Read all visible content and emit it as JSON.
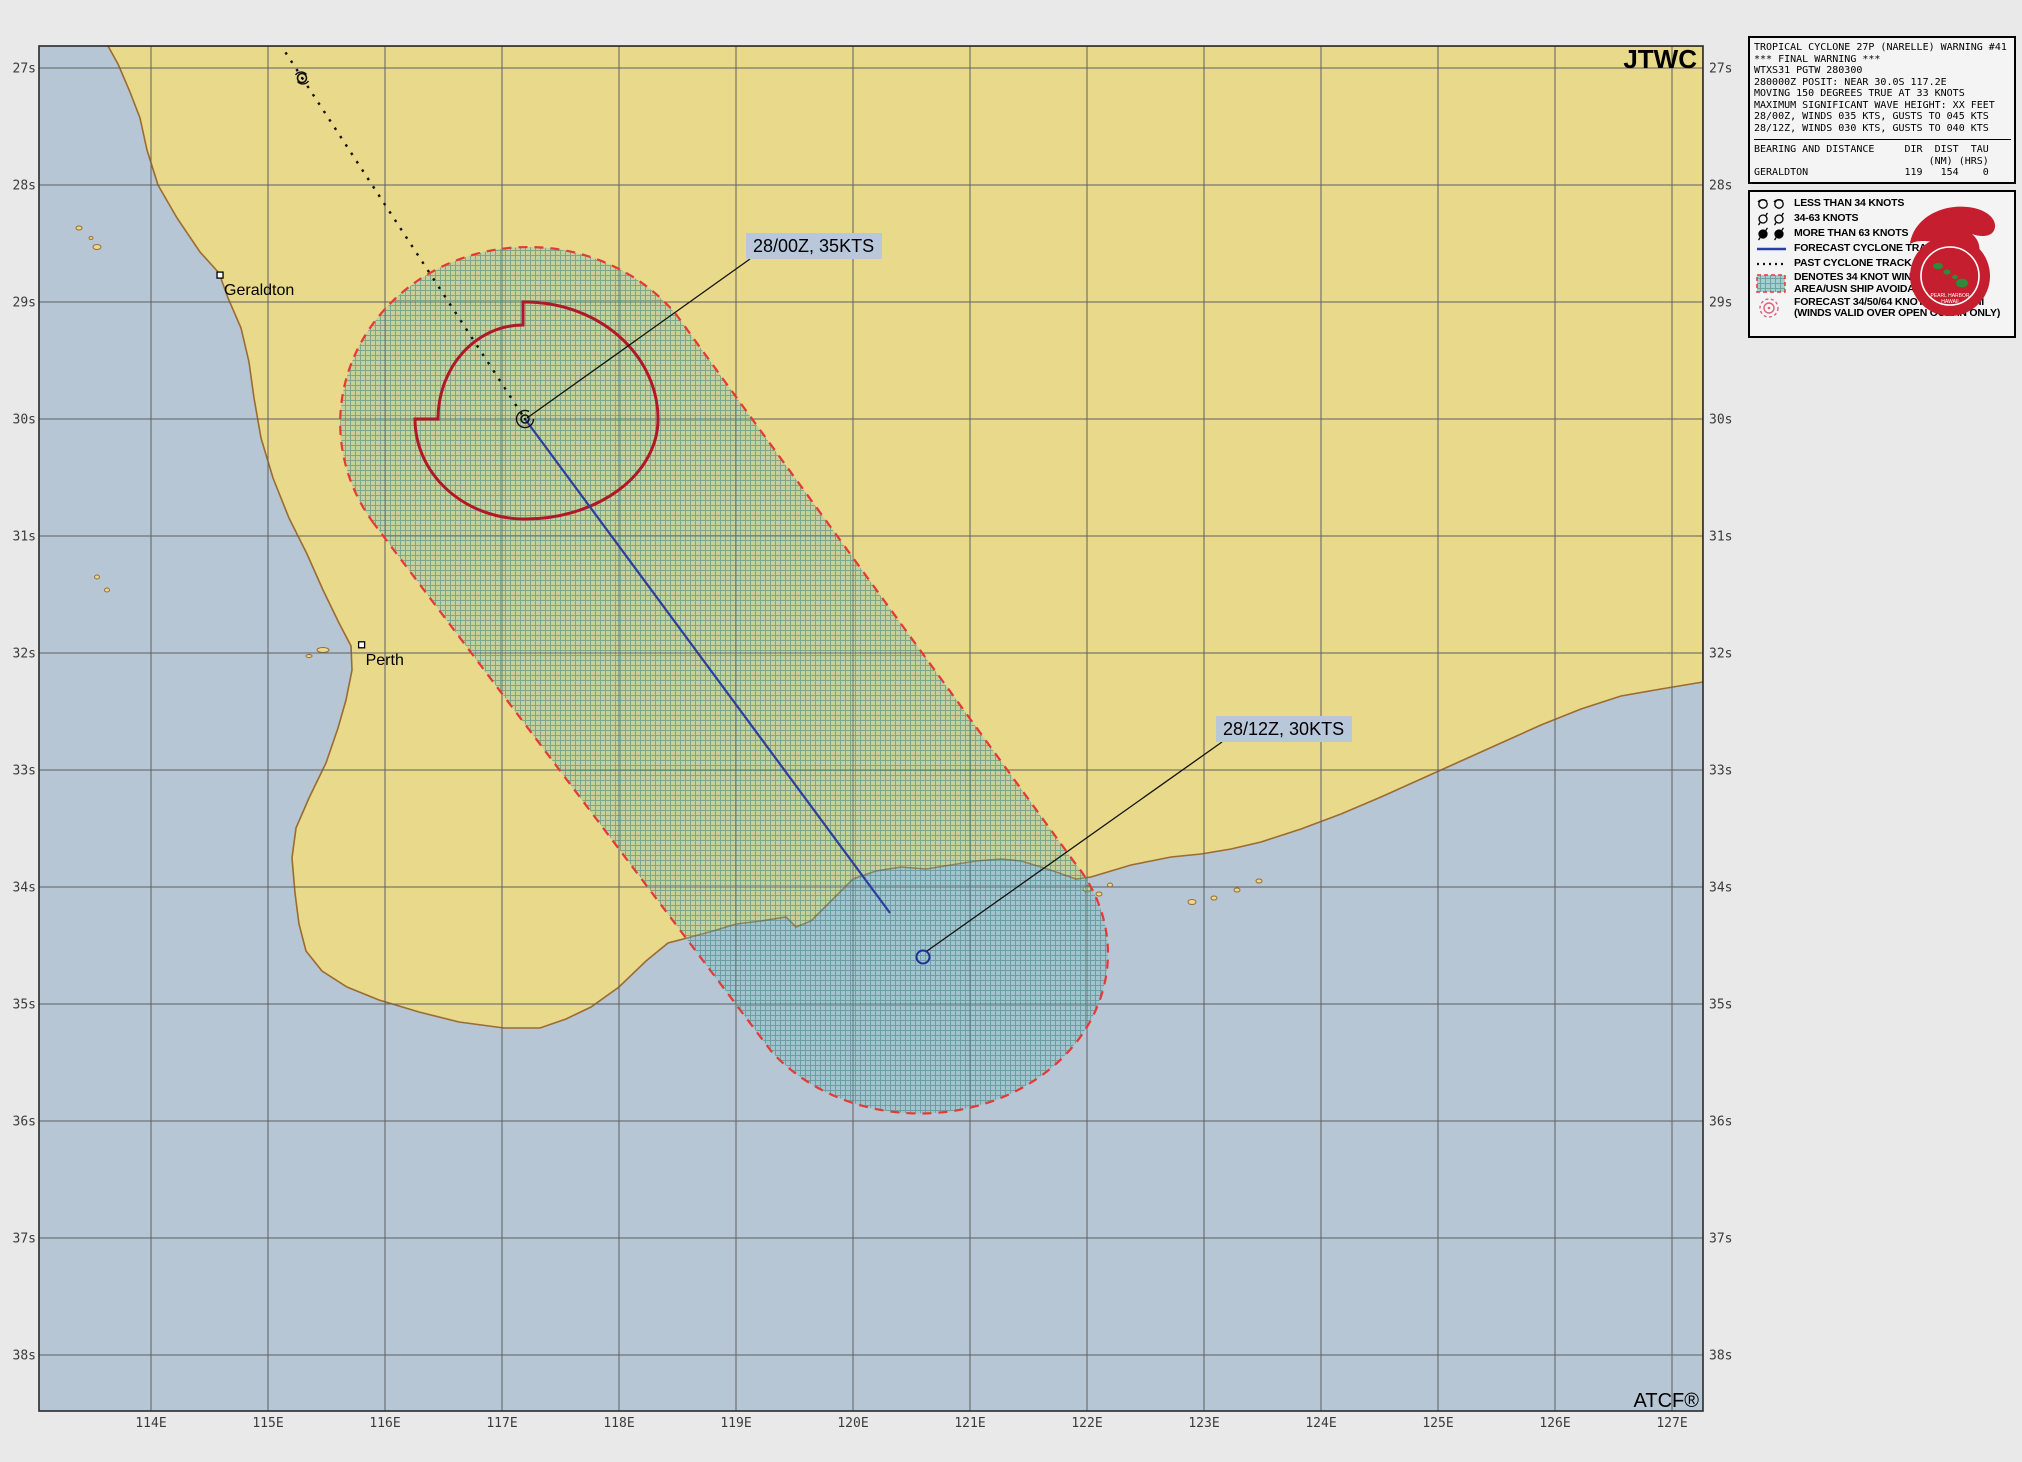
{
  "title": {
    "agency_watermark": "JTWC",
    "software_watermark": "ATCF®"
  },
  "warning_box": {
    "text": "TROPICAL CYCLONE 27P (NARELLE) WARNING #41\n*** FINAL WARNING ***\nWTXS31 PGTW 280300\n280000Z POSIT: NEAR 30.0S 117.2E\nMOVING 150 DEGREES TRUE AT 33 KNOTS\nMAXIMUM SIGNIFICANT WAVE HEIGHT: XX FEET\n28/00Z, WINDS 035 KTS, GUSTS TO 045 KTS\n28/12Z, WINDS 030 KTS, GUSTS TO 040 KTS",
    "bearing_text": "BEARING AND DISTANCE     DIR  DIST  TAU\n                             (NM) (HRS)\nGERALDTON                119   154    0"
  },
  "legend": {
    "items": [
      {
        "id": "lt34",
        "label": "LESS THAN 34 KNOTS"
      },
      {
        "id": "34-63",
        "label": "34-63 KNOTS"
      },
      {
        "id": "gt63",
        "label": "MORE THAN 63 KNOTS"
      },
      {
        "id": "forecast-track",
        "label": "FORECAST CYCLONE TRACK"
      },
      {
        "id": "past-track",
        "label": "PAST CYCLONE TRACK"
      },
      {
        "id": "danger-area",
        "label": "DENOTES 34 KNOT WIND DANGER\nAREA/USN SHIP AVOIDANCE AREA"
      },
      {
        "id": "wind-radii",
        "label": "FORECAST 34/50/64 KNOT WIND RADII\n(WINDS VALID OVER OPEN OCEAN ONLY)"
      }
    ]
  },
  "map": {
    "track_labels": [
      {
        "text": "28/00Z, 35KTS"
      },
      {
        "text": "28/12Z, 30KTS"
      }
    ],
    "cities": [
      {
        "name": "Geraldton",
        "lat_s": 28.77,
        "lon_e": 114.59
      },
      {
        "name": "Perth",
        "lat_s": 31.93,
        "lon_e": 115.8
      }
    ],
    "storm": {
      "id": "27P",
      "name": "NARELLE",
      "current": {
        "time": "28/00Z",
        "lat_s": 30.0,
        "lon_e": 117.2,
        "winds_kts": 35
      },
      "forecast": {
        "time": "28/12Z",
        "lat_s": 34.6,
        "lon_e": 120.6,
        "winds_kts": 30
      }
    },
    "lat_ticks": [
      {
        "label": "27s",
        "value": 27
      },
      {
        "label": "28s",
        "value": 28
      },
      {
        "label": "29s",
        "value": 29
      },
      {
        "label": "30s",
        "value": 30
      },
      {
        "label": "31s",
        "value": 31
      },
      {
        "label": "32s",
        "value": 32
      },
      {
        "label": "33s",
        "value": 33
      },
      {
        "label": "34s",
        "value": 34
      },
      {
        "label": "35s",
        "value": 35
      },
      {
        "label": "36s",
        "value": 36
      },
      {
        "label": "37s",
        "value": 37
      },
      {
        "label": "38s",
        "value": 38
      }
    ],
    "lon_ticks": [
      {
        "label": "114E",
        "value": 114
      },
      {
        "label": "115E",
        "value": 115
      },
      {
        "label": "116E",
        "value": 116
      },
      {
        "label": "117E",
        "value": 117
      },
      {
        "label": "118E",
        "value": 118
      },
      {
        "label": "119E",
        "value": 119
      },
      {
        "label": "120E",
        "value": 120
      },
      {
        "label": "121E",
        "value": 121
      },
      {
        "label": "122E",
        "value": 122
      },
      {
        "label": "123E",
        "value": 123
      },
      {
        "label": "124E",
        "value": 124
      },
      {
        "label": "125E",
        "value": 125
      },
      {
        "label": "126E",
        "value": 126
      },
      {
        "label": "127E",
        "value": 127
      }
    ],
    "colors": {
      "land": "#e9d98b",
      "ocean": "#b6c6d5",
      "coast": "#9b6b30",
      "grid": "#5f5f5f",
      "danger_border": "#e53935",
      "danger_tint": "#7dbebe",
      "wind_radii": "#b01828",
      "forecast_track": "#2b3fa0",
      "past_track": "#111111",
      "label_bg": "#b9c7da"
    }
  }
}
